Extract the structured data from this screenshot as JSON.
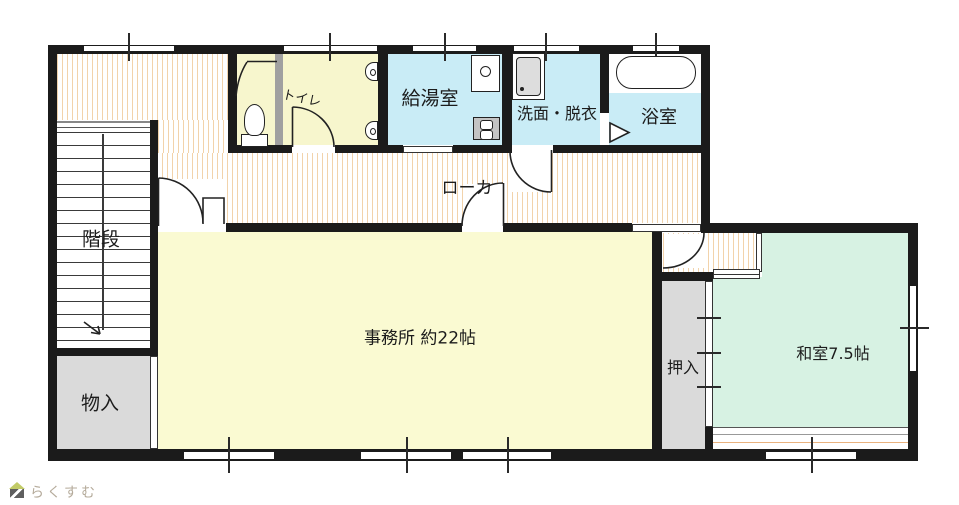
{
  "plan": {
    "title": "floor-plan",
    "rooms": {
      "stairs": {
        "label": "階段"
      },
      "toilet": {
        "label": "トイレ"
      },
      "kitchenette": {
        "label": "給湯室"
      },
      "washroom": {
        "label": "洗面・脱衣"
      },
      "bathroom": {
        "label": "浴室"
      },
      "corridor": {
        "label": "ローカ"
      },
      "office": {
        "label": "事務所 約22帖"
      },
      "closet": {
        "label": "押入"
      },
      "japanese_room": {
        "label": "和室7.5帖"
      },
      "storage": {
        "label": "物入"
      }
    },
    "colors": {
      "wall": "#1b1b1b",
      "office_floor": "#fafad2",
      "toilet_floor": "#f7f6cd",
      "wet_room_floor": "#c9ecf6",
      "tatami_floor": "#d7f2e3",
      "closet_floor": "#dadada",
      "hall_stripe": "#f2d3ab",
      "engawa_line": "#e9b27e",
      "partition_gray": "#a0a0a0"
    }
  },
  "footer": {
    "logo_text": "らくすむ",
    "logo_icon": "house-icon"
  }
}
